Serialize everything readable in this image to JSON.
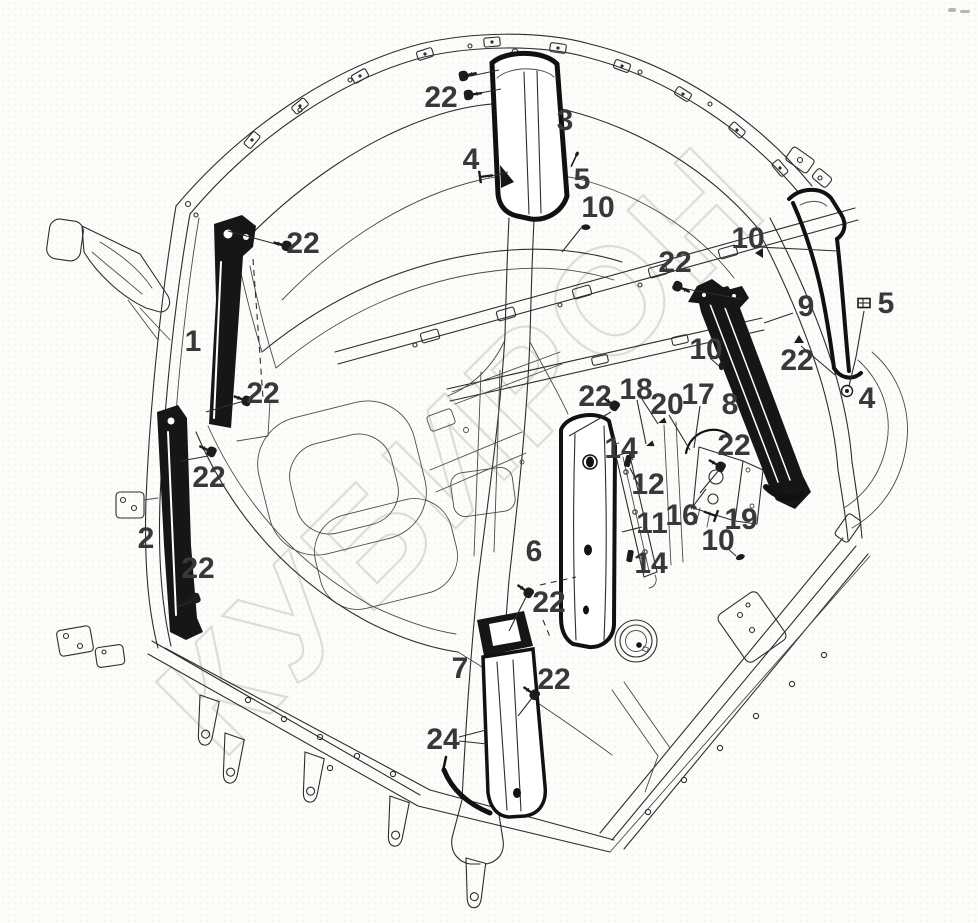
{
  "watermark": {
    "text": "КУБИРОН"
  },
  "colors": {
    "line": "#2d2d2d",
    "part_fill": "#161616",
    "callout_text": "#383838",
    "watermark_stroke": "#d8d8d3",
    "background": "#fcfcfa"
  },
  "callouts": [
    {
      "label": "22",
      "x": 441,
      "y": 97
    },
    {
      "label": "3",
      "x": 565,
      "y": 120
    },
    {
      "label": "4",
      "x": 471,
      "y": 159
    },
    {
      "label": "5",
      "x": 582,
      "y": 179
    },
    {
      "label": "10",
      "x": 598,
      "y": 207
    },
    {
      "label": "22",
      "x": 303,
      "y": 243
    },
    {
      "label": "10",
      "x": 748,
      "y": 238
    },
    {
      "label": "22",
      "x": 675,
      "y": 262
    },
    {
      "label": "9",
      "x": 806,
      "y": 306
    },
    {
      "label": "5",
      "x": 886,
      "y": 303
    },
    {
      "label": "22",
      "x": 797,
      "y": 360
    },
    {
      "label": "4",
      "x": 867,
      "y": 398
    },
    {
      "label": "8",
      "x": 730,
      "y": 404
    },
    {
      "label": "1",
      "x": 193,
      "y": 341
    },
    {
      "label": "22",
      "x": 263,
      "y": 393
    },
    {
      "label": "10",
      "x": 706,
      "y": 349
    },
    {
      "label": "18",
      "x": 636,
      "y": 389
    },
    {
      "label": "22",
      "x": 595,
      "y": 396
    },
    {
      "label": "20",
      "x": 667,
      "y": 404
    },
    {
      "label": "17",
      "x": 698,
      "y": 394
    },
    {
      "label": "14",
      "x": 621,
      "y": 448
    },
    {
      "label": "22",
      "x": 734,
      "y": 445
    },
    {
      "label": "12",
      "x": 648,
      "y": 484
    },
    {
      "label": "11",
      "x": 652,
      "y": 523
    },
    {
      "label": "16",
      "x": 682,
      "y": 515
    },
    {
      "label": "19",
      "x": 741,
      "y": 519
    },
    {
      "label": "10",
      "x": 718,
      "y": 540
    },
    {
      "label": "14",
      "x": 651,
      "y": 563
    },
    {
      "label": "2",
      "x": 146,
      "y": 538
    },
    {
      "label": "22",
      "x": 209,
      "y": 477
    },
    {
      "label": "22",
      "x": 198,
      "y": 568
    },
    {
      "label": "6",
      "x": 534,
      "y": 551
    },
    {
      "label": "22",
      "x": 549,
      "y": 602
    },
    {
      "label": "22",
      "x": 554,
      "y": 679
    },
    {
      "label": "7",
      "x": 460,
      "y": 668
    },
    {
      "label": "24",
      "x": 443,
      "y": 739
    }
  ],
  "leaders": [
    {
      "x1": 466,
      "y1": 77,
      "x2": 499,
      "y2": 70
    },
    {
      "x1": 470,
      "y1": 95,
      "x2": 501,
      "y2": 89
    },
    {
      "x1": 488,
      "y1": 177,
      "x2": 508,
      "y2": 172
    },
    {
      "x1": 581,
      "y1": 228,
      "x2": 562,
      "y2": 252
    },
    {
      "x1": 283,
      "y1": 246,
      "x2": 228,
      "y2": 231
    },
    {
      "x1": 244,
      "y1": 401,
      "x2": 206,
      "y2": 412
    },
    {
      "x1": 758,
      "y1": 247,
      "x2": 838,
      "y2": 251
    },
    {
      "x1": 681,
      "y1": 288,
      "x2": 741,
      "y2": 299
    },
    {
      "x1": 793,
      "y1": 313,
      "x2": 764,
      "y2": 323
    },
    {
      "x1": 864,
      "y1": 311,
      "x2": 856,
      "y2": 357
    },
    {
      "x1": 856,
      "y1": 357,
      "x2": 849,
      "y2": 386
    },
    {
      "x1": 801,
      "y1": 346,
      "x2": 835,
      "y2": 375
    },
    {
      "x1": 637,
      "y1": 400,
      "x2": 646,
      "y2": 444
    },
    {
      "x1": 642,
      "y1": 399,
      "x2": 658,
      "y2": 424
    },
    {
      "x1": 669,
      "y1": 415,
      "x2": 690,
      "y2": 450
    },
    {
      "x1": 700,
      "y1": 406,
      "x2": 694,
      "y2": 448
    },
    {
      "x1": 611,
      "y1": 412,
      "x2": 569,
      "y2": 436
    },
    {
      "x1": 719,
      "y1": 470,
      "x2": 700,
      "y2": 493
    },
    {
      "x1": 641,
      "y1": 490,
      "x2": 630,
      "y2": 468
    },
    {
      "x1": 642,
      "y1": 527,
      "x2": 622,
      "y2": 532
    },
    {
      "x1": 691,
      "y1": 509,
      "x2": 706,
      "y2": 489
    },
    {
      "x1": 710,
      "y1": 358,
      "x2": 719,
      "y2": 366
    },
    {
      "x1": 726,
      "y1": 547,
      "x2": 736,
      "y2": 556
    },
    {
      "x1": 629,
      "y1": 452,
      "x2": 633,
      "y2": 460
    },
    {
      "x1": 645,
      "y1": 559,
      "x2": 635,
      "y2": 557
    },
    {
      "x1": 526,
      "y1": 597,
      "x2": 509,
      "y2": 631
    },
    {
      "x1": 532,
      "y1": 698,
      "x2": 518,
      "y2": 716
    },
    {
      "x1": 459,
      "y1": 737,
      "x2": 486,
      "y2": 730
    },
    {
      "x1": 459,
      "y1": 741,
      "x2": 487,
      "y2": 744
    },
    {
      "x1": 208,
      "y1": 456,
      "x2": 181,
      "y2": 461
    },
    {
      "x1": 193,
      "y1": 601,
      "x2": 177,
      "y2": 607
    }
  ],
  "dashed_lines": [
    {
      "x1": 253,
      "y1": 259,
      "x2": 263,
      "y2": 398
    },
    {
      "x1": 540,
      "y1": 585,
      "x2": 576,
      "y2": 577
    },
    {
      "x1": 543,
      "y1": 620,
      "x2": 550,
      "y2": 637
    }
  ],
  "fasteners": [
    {
      "type": "screw",
      "x": 463,
      "y": 76,
      "rot": -12
    },
    {
      "type": "screw",
      "x": 468,
      "y": 95,
      "rot": -8
    },
    {
      "type": "flat",
      "x": 480,
      "y": 177,
      "rot": -8
    },
    {
      "type": "pin",
      "x": 577,
      "y": 154,
      "rot": 115
    },
    {
      "type": "hookclip",
      "x": 583,
      "y": 225,
      "rot": 20
    },
    {
      "type": "screw",
      "x": 287,
      "y": 246,
      "rot": 195
    },
    {
      "type": "screw",
      "x": 247,
      "y": 401,
      "rot": 200
    },
    {
      "type": "screw",
      "x": 212,
      "y": 452,
      "rot": 205
    },
    {
      "type": "screw",
      "x": 196,
      "y": 598,
      "rot": 160
    },
    {
      "type": "screw",
      "x": 615,
      "y": 406,
      "rot": 215
    },
    {
      "type": "screw",
      "x": 677,
      "y": 286,
      "rot": 25
    },
    {
      "type": "triclip",
      "x": 799,
      "y": 340,
      "rot": 0
    },
    {
      "type": "rectclip",
      "x": 864,
      "y": 303,
      "rot": 0
    },
    {
      "type": "grommet",
      "x": 847,
      "y": 391,
      "rot": 0
    },
    {
      "type": "triclip",
      "x": 760,
      "y": 253,
      "rot": -90
    },
    {
      "type": "hookclip",
      "x": 719,
      "y": 368,
      "rot": -60
    },
    {
      "type": "hookclip",
      "x": 737,
      "y": 556,
      "rot": 0
    },
    {
      "type": "screw",
      "x": 529,
      "y": 593,
      "rot": 215
    },
    {
      "type": "screw",
      "x": 535,
      "y": 695,
      "rot": 215
    },
    {
      "type": "screw",
      "x": 721,
      "y": 467,
      "rot": 210
    },
    {
      "type": "flat",
      "x": 716,
      "y": 516,
      "rot": 200
    },
    {
      "type": "flag",
      "x": 646,
      "y": 446,
      "rot": -20
    },
    {
      "type": "flag",
      "x": 658,
      "y": 423,
      "rot": -20
    },
    {
      "type": "darkclip",
      "x": 628,
      "y": 461,
      "rot": 15
    },
    {
      "type": "darkclip",
      "x": 630,
      "y": 556,
      "rot": 10
    }
  ]
}
